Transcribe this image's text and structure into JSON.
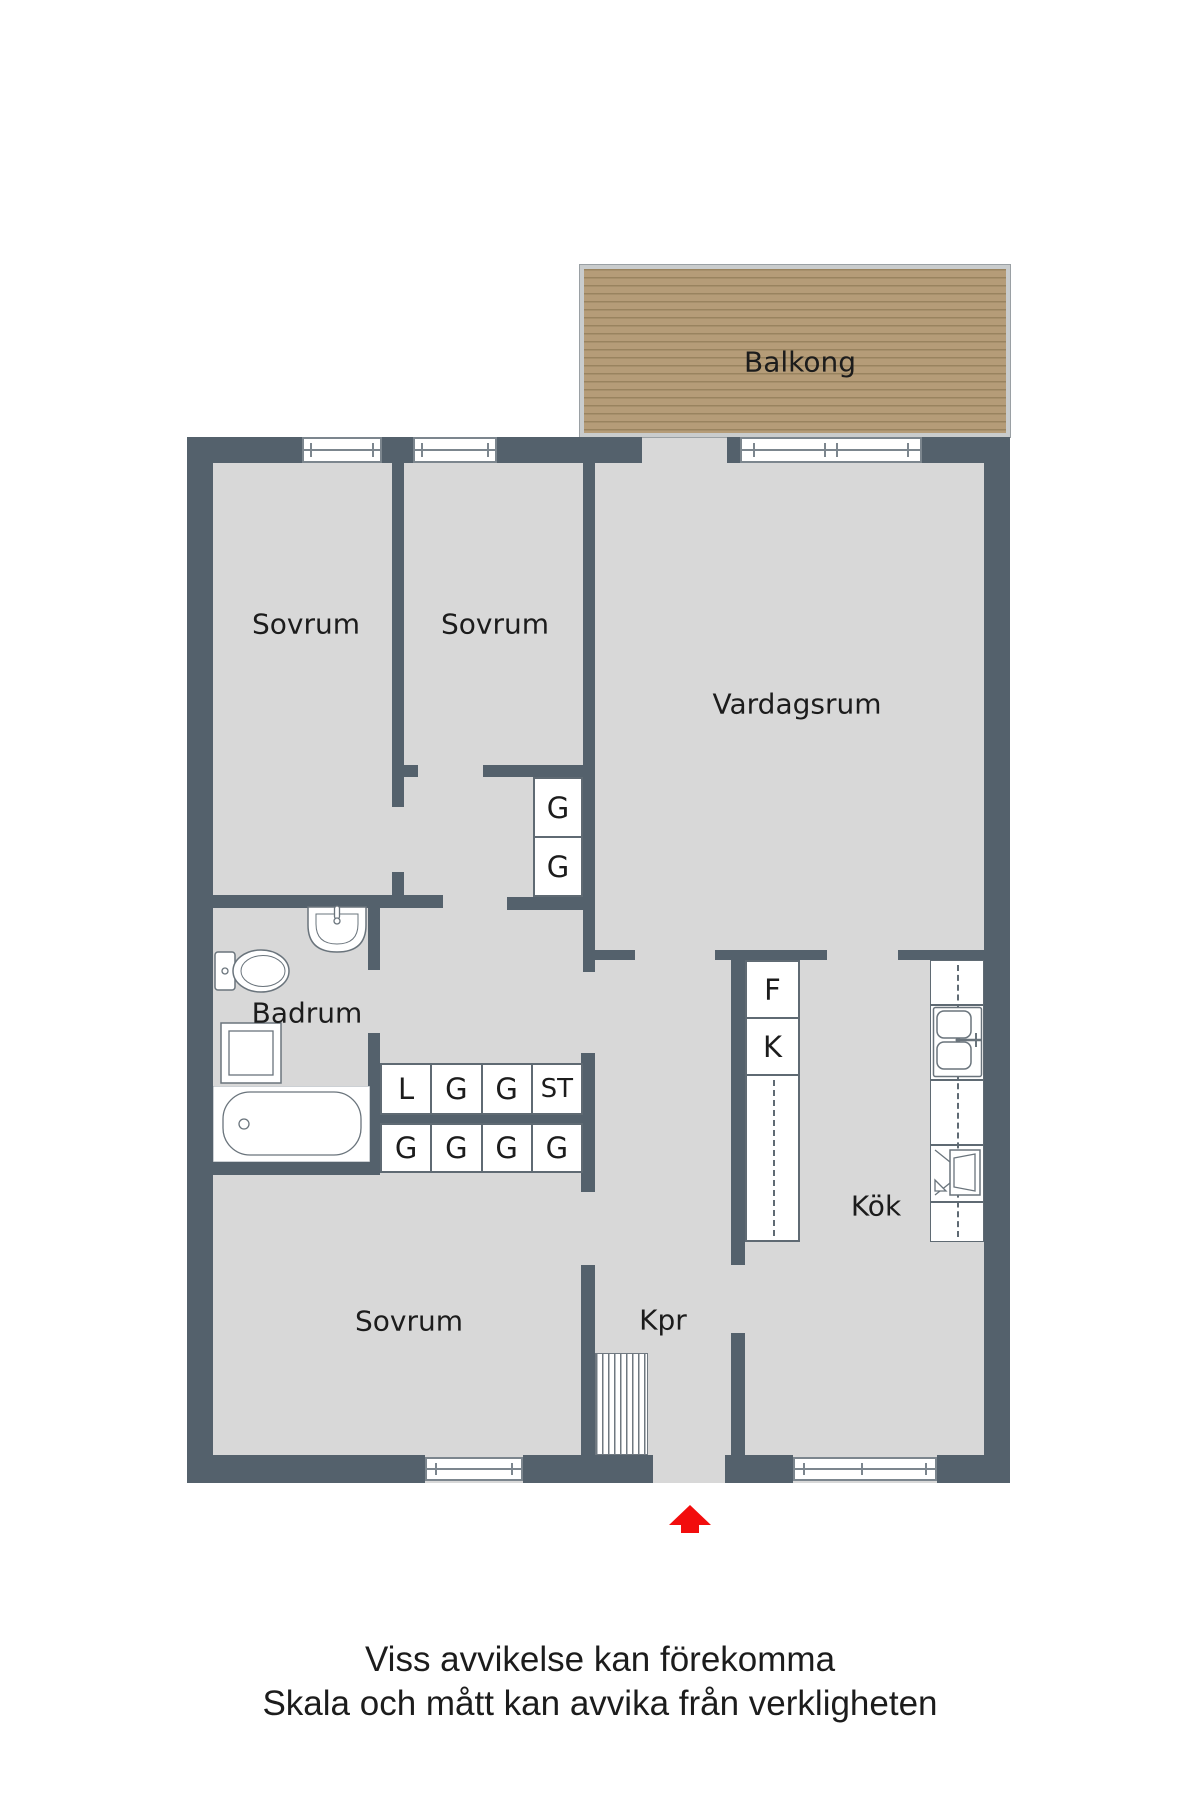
{
  "floorplan": {
    "rooms": {
      "balcony": "Balkong",
      "bedroom_top_left": "Sovrum",
      "bedroom_top_middle": "Sovrum",
      "living_room": "Vardagsrum",
      "bathroom": "Badrum",
      "kitchen": "Kök",
      "bedroom_bottom": "Sovrum",
      "hallway": "Kpr"
    },
    "closets": {
      "wardrobe_column": [
        "G",
        "G"
      ],
      "hall_row_top": [
        "L",
        "G",
        "G",
        "ST"
      ],
      "hall_row_bottom": [
        "G",
        "G",
        "G",
        "G"
      ],
      "fridge": "F",
      "freezer": "K"
    },
    "icons": [
      "toilet-icon",
      "sink-icon",
      "washing-machine-icon",
      "bathtub-icon",
      "kitchen-sink-icon",
      "stove-icon",
      "stairs-icon",
      "entrance-arrow-icon"
    ],
    "disclaimer": {
      "line1": "Viss avvikelse kan förekomma",
      "line2": "Skala och mått kan avvika från verkligheten"
    },
    "colors": {
      "wall": "#54616c",
      "floor": "#d8d8d8",
      "line": "#5f6a73",
      "window_frame": "#7c868e",
      "wood": "#b59c78",
      "wood_line": "#99835f",
      "balcony_frame": "#c9cccd",
      "text": "#1c1c1c",
      "arrow": "#f20d0d",
      "fixture": "#6a747c"
    }
  }
}
